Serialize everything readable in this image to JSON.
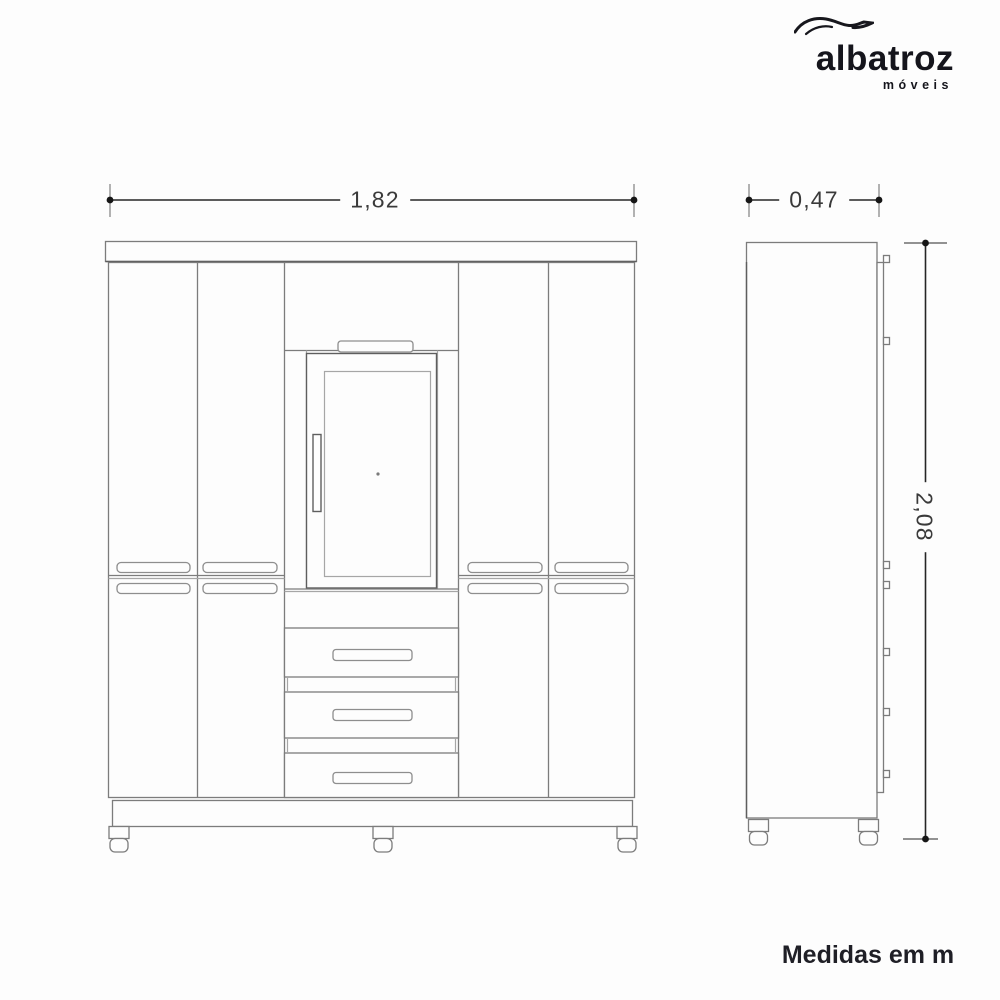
{
  "brand": {
    "name": "albatroz",
    "tagline": "móveis",
    "icon": "albatross-swoosh-icon",
    "ink_color": "#17171d"
  },
  "dimensions": {
    "front_width_m": "1,82",
    "side_depth_m": "0,47",
    "side_height_m": "2,08"
  },
  "footer": {
    "units_note": "Medidas em m"
  },
  "colors": {
    "background": "#fdfdfd",
    "dimension_line": "#262626",
    "drawing_line_dark": "#5e5e5e",
    "drawing_line_light": "#a6a6a6"
  }
}
